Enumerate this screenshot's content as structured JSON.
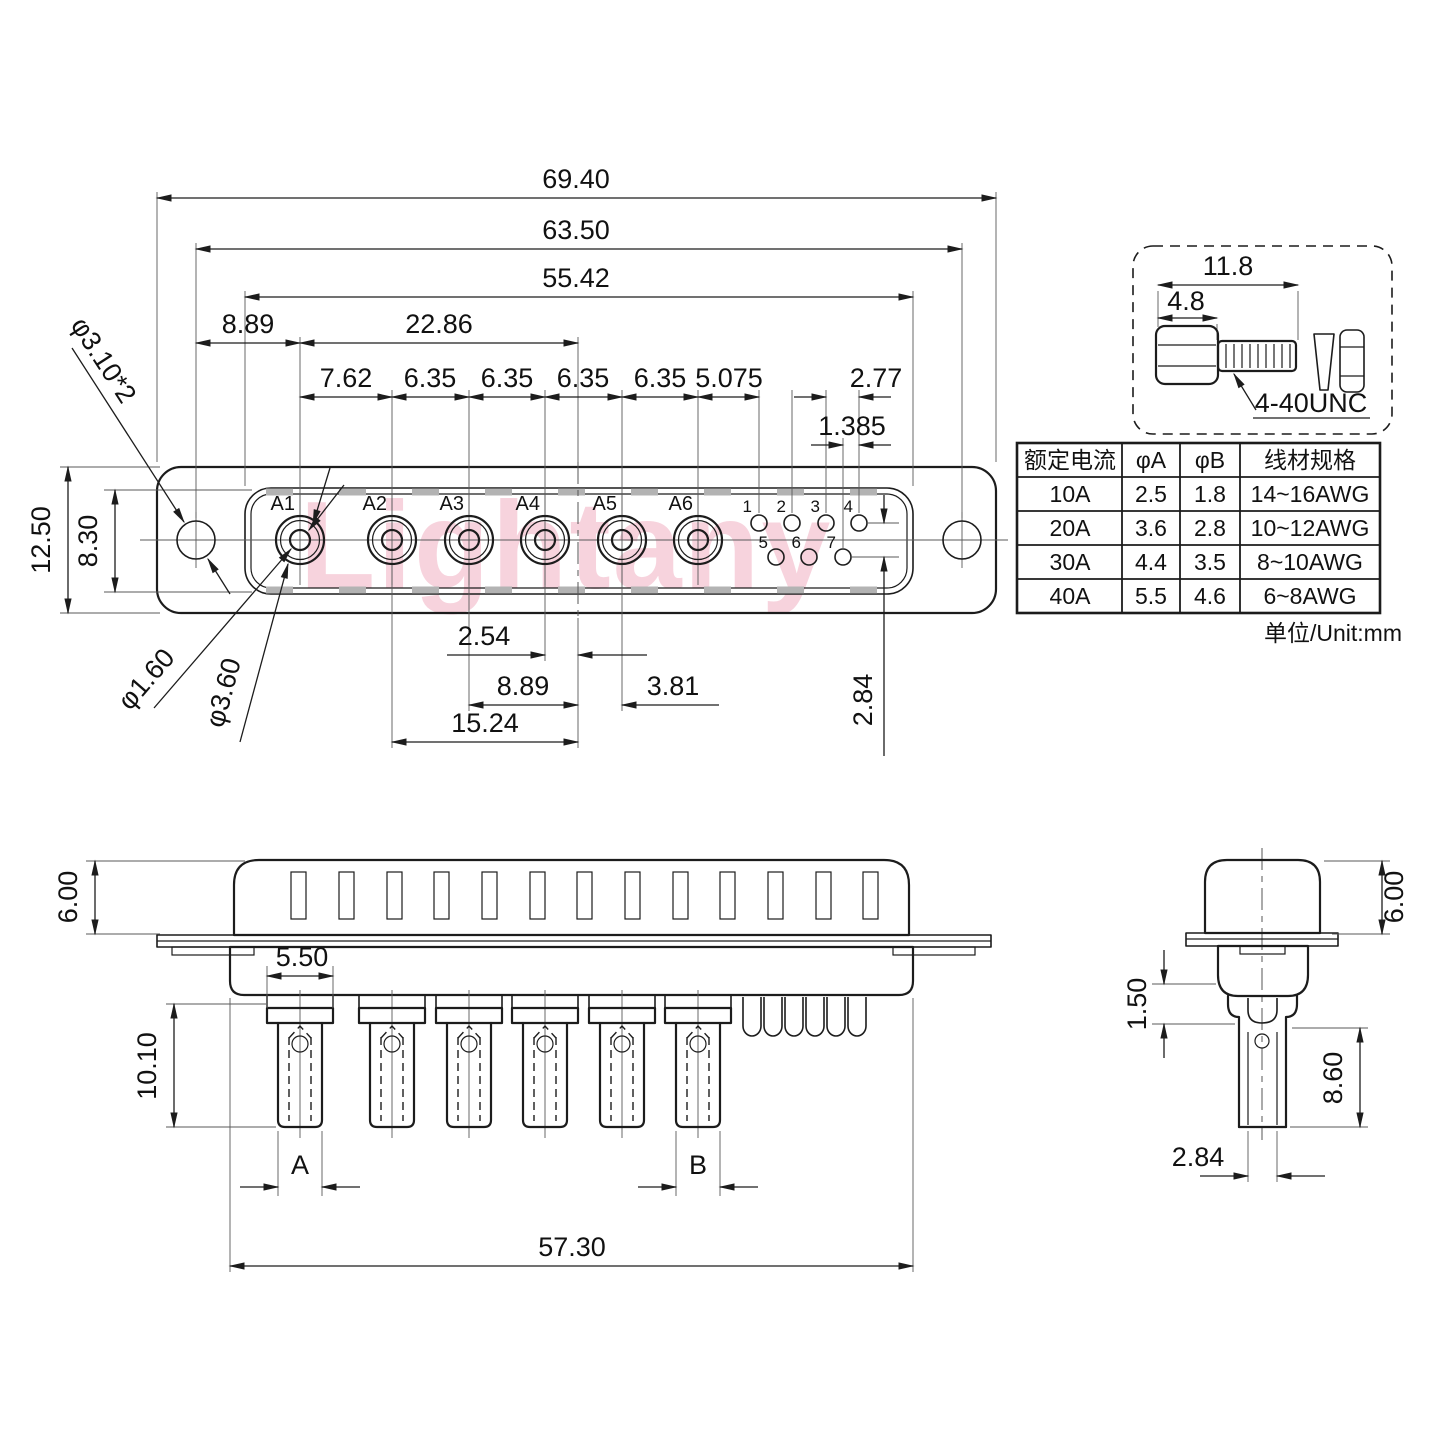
{
  "watermark": "Lightany",
  "unit_label": "单位/Unit:mm",
  "top_view": {
    "pin_labels": [
      "A1",
      "A2",
      "A3",
      "A4",
      "A5",
      "A6"
    ],
    "small_pin_labels_top": [
      "1",
      "2",
      "3",
      "4"
    ],
    "small_pin_labels_bottom": [
      "5",
      "6",
      "7"
    ],
    "dim_overall_width": "69.40",
    "dim_mount_spacing": "63.50",
    "dim_opening_width": "55.42",
    "dim_mount_to_a1": "8.89",
    "dim_a1_to_center": "22.86",
    "pitches": [
      "7.62",
      "6.35",
      "6.35",
      "6.35",
      "6.35",
      "5.075",
      "2.77"
    ],
    "dim_row_offset": "1.385",
    "dim_body_height": "12.50",
    "dim_opening_height": "8.30",
    "leader_mount_hole": "φ3.10*2",
    "leader_pin_bore": "φ1.60",
    "leader_pin_outer": "φ3.60",
    "dim_a4_to_center": "2.54",
    "dim_a3_to_center": "8.89",
    "dim_center_to_a5": "3.81",
    "dim_a2_to_center": "15.24",
    "dim_small_row_gap": "2.84"
  },
  "screw_detail": {
    "dim_total_length": "11.8",
    "dim_head_length": "4.8",
    "thread_label": "4-40UNC"
  },
  "spec_table": {
    "headers": [
      "额定电流",
      "φA",
      "φB",
      "线材规格"
    ],
    "rows": [
      [
        "10A",
        "2.5",
        "1.8",
        "14~16AWG"
      ],
      [
        "20A",
        "3.6",
        "2.8",
        "10~12AWG"
      ],
      [
        "30A",
        "4.4",
        "3.5",
        "8~10AWG"
      ],
      [
        "40A",
        "5.5",
        "4.6",
        "6~8AWG"
      ]
    ]
  },
  "side_view": {
    "dim_shell_height": "6.00",
    "dim_collar_width": "5.50",
    "dim_pin_length": "10.10",
    "label_a": "A",
    "label_b": "B",
    "dim_body_width": "57.30"
  },
  "end_view": {
    "dim_shell_height": "6.00",
    "dim_step": "1.50",
    "dim_barrel_length": "8.60",
    "dim_pin_width": "2.84"
  }
}
